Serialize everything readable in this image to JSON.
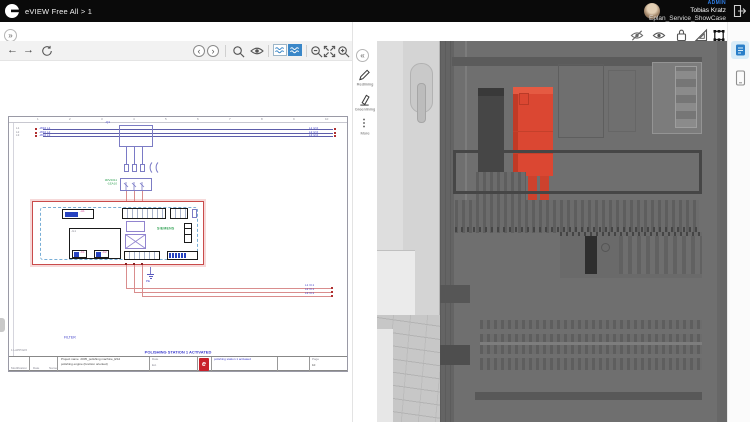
{
  "topbar": {
    "app_title": "eVIEW Free All > 1",
    "user_role": "ADMIN",
    "user_name": "Tobias Kratz",
    "project_name": "Eplan_Service_ShowCase"
  },
  "icons": {
    "expand": "»",
    "collapse": "«",
    "back": "←",
    "forward": "→",
    "prev": "‹",
    "next": "›",
    "more_glyph": "⋮"
  },
  "side_tools": {
    "redlining": "Redlining",
    "greenlining": "Greenlining",
    "more": "More"
  },
  "colors": {
    "accent_blue": "#3a87c8",
    "highlight_red": "#db4732",
    "schematic_red": "#c94b4b",
    "schematic_blue": "#7a7ac6",
    "siemens_green": "#2fa052",
    "eplan_red": "#c8202a"
  },
  "schematic": {
    "ruler": [
      "1",
      "2",
      "3",
      "4",
      "5",
      "6",
      "7",
      "8",
      "9",
      "10"
    ],
    "bus_left": [
      {
        "gray": "L1",
        "blue": "-W10 L1"
      },
      {
        "gray": "L2",
        "blue": "-W10 L2"
      },
      {
        "gray": "L3",
        "blue": "-W10 L3"
      }
    ],
    "bus_right": [
      "L1 /2.0",
      "L2 /2.0",
      "L3 /2.0"
    ],
    "breaker_label": "-Q1",
    "green_label_1": "3RV2011",
    "green_label_2": "-1EA10",
    "siemens": "SIEMENS",
    "chip_a": "-A1",
    "box_d_label": "-G1",
    "chips": [
      "-K1",
      "-K2"
    ],
    "out_labels": [
      "L1 /3.1",
      "L2 /3.1",
      "L3 /3.1"
    ],
    "pe_label": "PE",
    "filter_label": "FILTER",
    "status_text": "POLISHING STATION 1 ACTIVATED",
    "plot_stamp": "1 LAPP32/2",
    "titleblock": {
      "project_label": "Project name",
      "project_name": "2005_polishing machine_ES4",
      "project_desc": "polishing engine (function oriented)",
      "date_label": "Date",
      "ed_label": "Ed.",
      "drawing_desc": "polishing station 1 activated",
      "page_label": "Page",
      "page_value": "10",
      "mod_label": "Modification",
      "name_label": "Name",
      "logo": "e"
    }
  }
}
